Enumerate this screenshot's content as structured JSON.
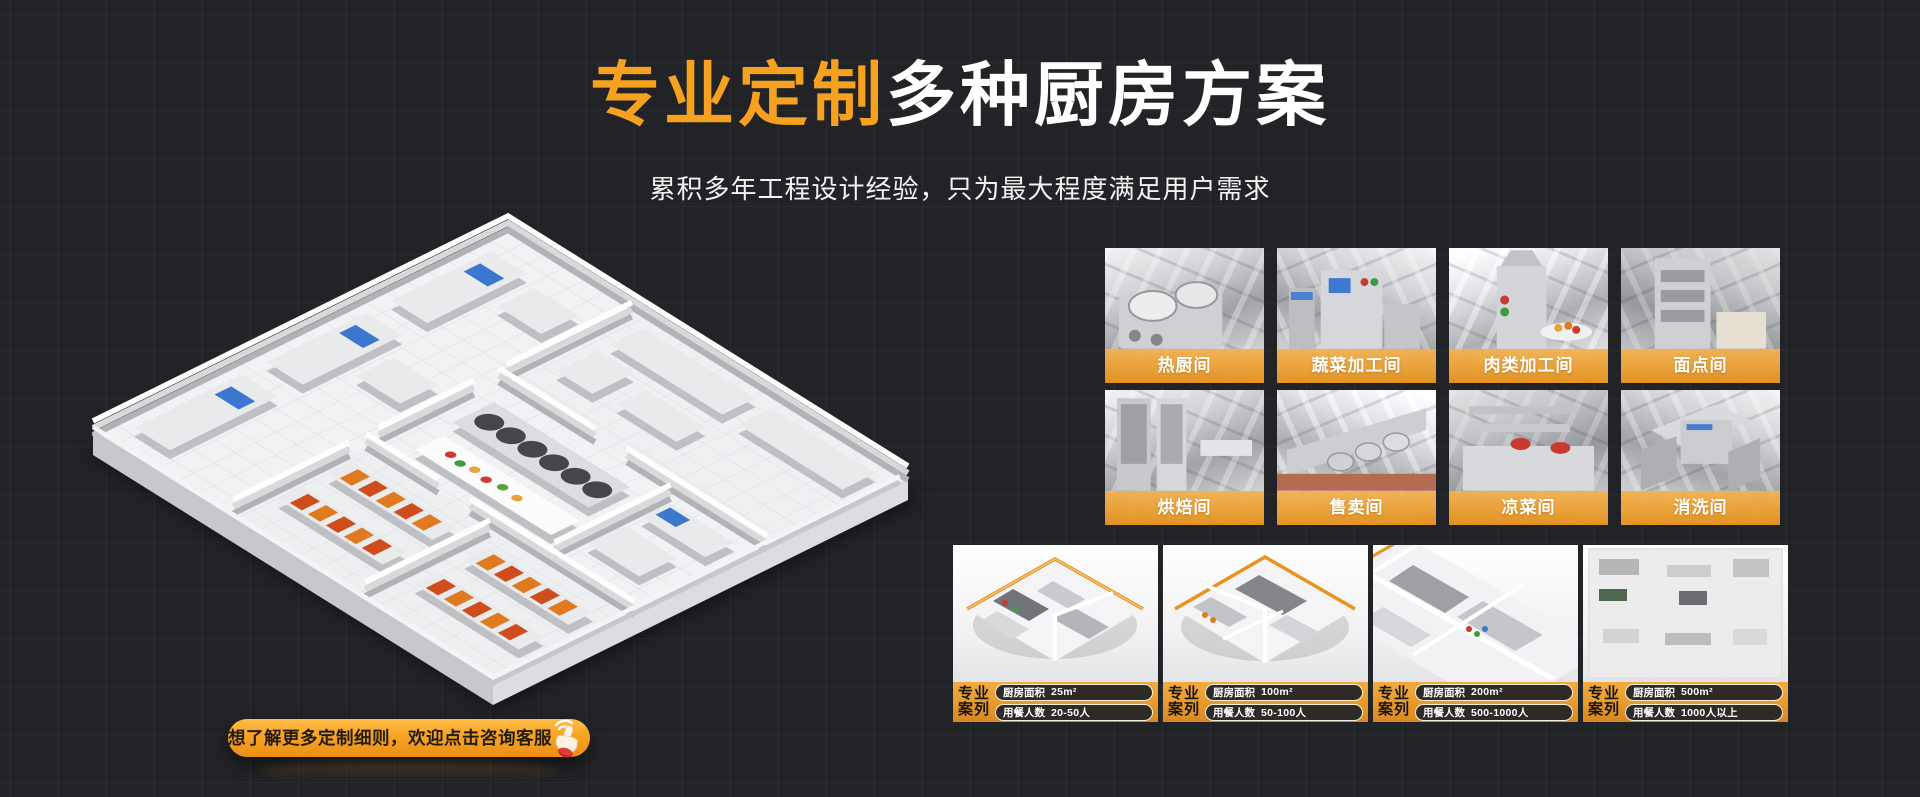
{
  "theme": {
    "background": "#222326",
    "grid_line": "#2b2c2f",
    "accent_orange": "#F6A11F",
    "label_bar_orange": "#E8A23A",
    "case_bar_orange": "#E79A2C",
    "pill_dark": "#2E2B27",
    "text_light": "#FFFFFF",
    "text_dark": "#231C0E"
  },
  "header": {
    "title_highlight": "专业定制",
    "title_rest": "多种厨房方案",
    "subtitle": "累积多年工程设计经验，只为最大程度满足用户需求"
  },
  "cta": {
    "label": "想了解更多定制细则，欢迎点击咨询客服",
    "icon": "click-hand-icon"
  },
  "rooms": [
    {
      "label": "热厨间"
    },
    {
      "label": "蔬菜加工间"
    },
    {
      "label": "肉类加工间"
    },
    {
      "label": "面点间"
    },
    {
      "label": "烘焙间"
    },
    {
      "label": "售卖间"
    },
    {
      "label": "凉菜间"
    },
    {
      "label": "消洗间"
    }
  ],
  "cases": [
    {
      "tag_line1": "专业",
      "tag_line2": "案列",
      "area_label": "厨房面积",
      "area_value": "25m²",
      "diners_label": "用餐人数",
      "diners_value": "20-50人"
    },
    {
      "tag_line1": "专业",
      "tag_line2": "案列",
      "area_label": "厨房面积",
      "area_value": "100m²",
      "diners_label": "用餐人数",
      "diners_value": "50-100人"
    },
    {
      "tag_line1": "专业",
      "tag_line2": "案列",
      "area_label": "厨房面积",
      "area_value": "200m²",
      "diners_label": "用餐人数",
      "diners_value": "500-1000人"
    },
    {
      "tag_line1": "专业",
      "tag_line2": "案列",
      "area_label": "厨房面积",
      "area_value": "500m²",
      "diners_label": "用餐人数",
      "diners_value": "1000人以上"
    }
  ]
}
